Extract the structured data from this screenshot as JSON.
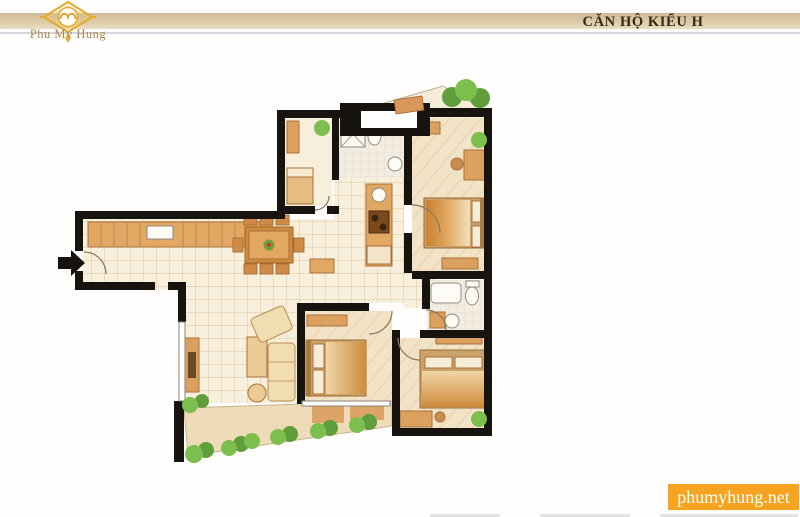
{
  "header": {
    "logo_text": "Phu My Hung",
    "logo_icon": "gold-diamond-emblem",
    "title": "CĂN HỘ KIỂU H",
    "bar_color": "#d5c29c"
  },
  "watermark": {
    "text": "phumyhung.net",
    "background": "#f6a41f",
    "text_color": "#ffffff"
  },
  "floorplan": {
    "type": "apartment-floor-plan",
    "rooms": [
      "kitchen",
      "dining-area",
      "living-room",
      "maid-room",
      "bathroom-1",
      "bathroom-2",
      "bedroom-1",
      "bedroom-2",
      "bedroom-3",
      "hallway",
      "balcony-top",
      "balcony-bottom"
    ],
    "features": [
      "entry-arrow",
      "shaft",
      "beds",
      "sofa-set",
      "dining-table",
      "kitchen-counters",
      "toilets",
      "bathtub",
      "shower",
      "shrubs",
      "trees"
    ],
    "colors": {
      "wall": "#17130e",
      "tile_floor": "#f8f0dc",
      "wood_floor": "#f2e2c6",
      "furniture": "#e2a763",
      "greenery": "#6fae42",
      "balcony": "#eedcb8"
    }
  }
}
